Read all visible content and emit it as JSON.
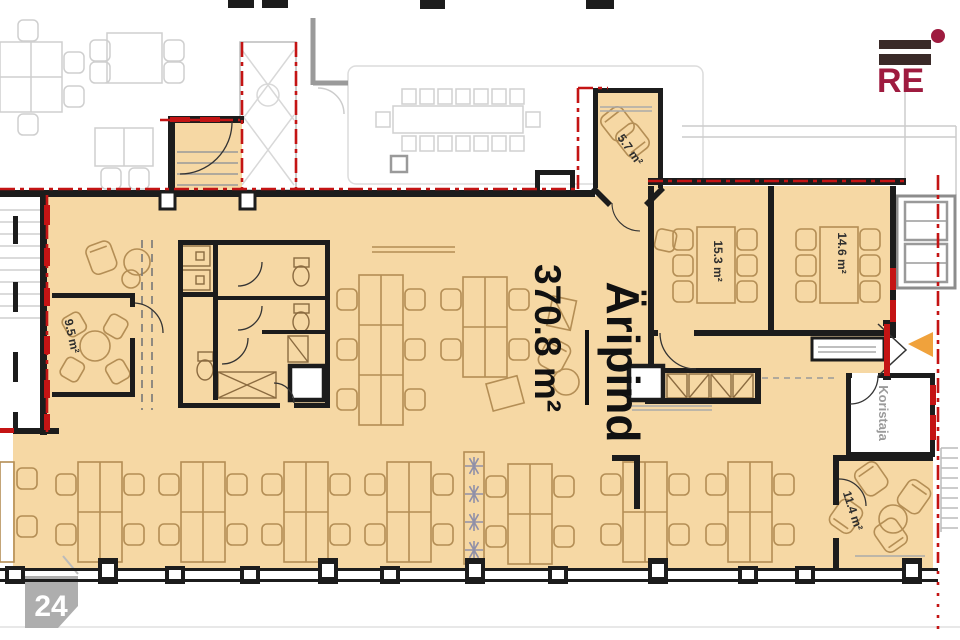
{
  "branding": {
    "logo_text": "RE"
  },
  "page_badge": "24",
  "floor": {
    "main_label": "Äripind",
    "main_area": "370.8 m²",
    "rooms": {
      "r57": "5.7 m²",
      "r153": "15.3 m²",
      "r146": "14.6 m²",
      "r95": "9.5 m²",
      "r114": "11.4 m²",
      "koristaja": "Koristaja"
    }
  },
  "colors": {
    "floor_fill": "#f6d8a4",
    "wall": "#1c1c1c",
    "boundary_red": "#c41414",
    "furniture_outline": "#b48e55",
    "neighbor_gray": "#cfcfcf",
    "logo_maroon": "#9e1b3f",
    "logo_bar": "#3a2a28",
    "badge_gray": "#a8a8a8",
    "arrow_orange": "#f0a23c"
  }
}
